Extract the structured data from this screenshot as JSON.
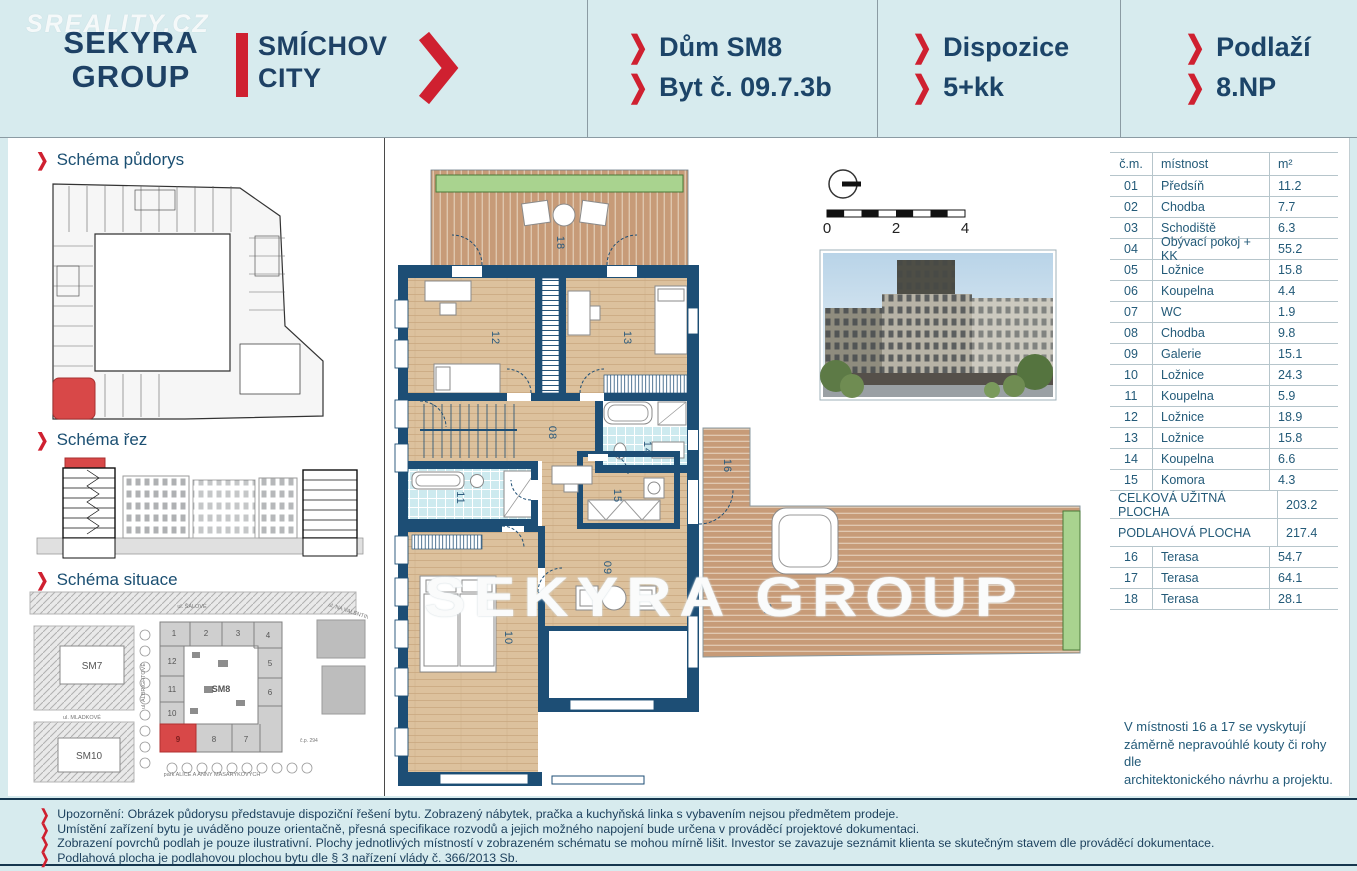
{
  "watermarks": {
    "sreality": "SREALITY.CZ",
    "brand": "SEKYRA GROUP"
  },
  "header": {
    "logo": {
      "line1": "SEKYRA",
      "line2": "GROUP",
      "project1": "SMÍCHOV",
      "project2": "CITY"
    },
    "sections": [
      {
        "line1": "Dům SM8",
        "line2": "Byt č. 09.7.3b"
      },
      {
        "line1": "Dispozice",
        "line2": "5+kk"
      },
      {
        "line1": "Podlaží",
        "line2": "8.NP"
      }
    ]
  },
  "sidebar": {
    "sections": [
      {
        "title": "Schéma půdorys"
      },
      {
        "title": "Schéma řez"
      },
      {
        "title": "Schéma situace"
      }
    ],
    "situace": {
      "blocks": {
        "sm7": "SM7",
        "sm8": "SM8",
        "sm10": "SM10"
      },
      "numbers": [
        "1",
        "2",
        "3",
        "4",
        "5",
        "6",
        "7",
        "8",
        "9",
        "10",
        "11",
        "12"
      ],
      "highlighted_number": "9",
      "streets": {
        "top": "ul. ŠÁLOVÉ",
        "right": "ul. NA VALENTINCE",
        "left_vertical": "ul. ALBRIGHTOVÉ",
        "mid": "ul. MLADKOVÉ",
        "park": "park ALICE A ANNY MASARYKOVÝCH",
        "cp": "č.p. 294"
      }
    }
  },
  "plan": {
    "room_labels": {
      "r08": "08",
      "r09": "09",
      "r10": "10",
      "r11": "11",
      "r12": "12",
      "r13": "13",
      "r14": "14",
      "r15": "15",
      "t16": "16",
      "t17": "17",
      "t18": "18"
    },
    "scale_ticks": {
      "t0": "0",
      "t2": "2",
      "t4": "4"
    }
  },
  "table": {
    "headers": [
      "č.m.",
      "místnost",
      "m²"
    ],
    "rows": [
      [
        "01",
        "Předsíň",
        "11.2"
      ],
      [
        "02",
        "Chodba",
        "7.7"
      ],
      [
        "03",
        "Schodiště",
        "6.3"
      ],
      [
        "04",
        "Obývací pokoj + KK",
        "55.2"
      ],
      [
        "05",
        "Ložnice",
        "15.8"
      ],
      [
        "06",
        "Koupelna",
        "4.4"
      ],
      [
        "07",
        "WC",
        "1.9"
      ],
      [
        "08",
        "Chodba",
        "9.8"
      ],
      [
        "09",
        "Galerie",
        "15.1"
      ],
      [
        "10",
        "Ložnice",
        "24.3"
      ],
      [
        "11",
        "Koupelna",
        "5.9"
      ],
      [
        "12",
        "Ložnice",
        "18.9"
      ],
      [
        "13",
        "Ložnice",
        "15.8"
      ],
      [
        "14",
        "Koupelna",
        "6.6"
      ],
      [
        "15",
        "Komora",
        "4.3"
      ]
    ],
    "summary": [
      [
        "CELKOVÁ UŽITNÁ PLOCHA",
        "203.2"
      ],
      [
        "PODLAHOVÁ PLOCHA",
        "217.4"
      ]
    ],
    "terrace_rows": [
      [
        "16",
        "Terasa",
        "54.7"
      ],
      [
        "17",
        "Terasa",
        "64.1"
      ],
      [
        "18",
        "Terasa",
        "28.1"
      ]
    ],
    "note_lines": [
      "V místnosti 16 a 17 se vyskytují",
      "záměrně nepravoúhlé kouty či rohy dle",
      "architektonického návrhu a projektu."
    ]
  },
  "disclaimer": {
    "lines": [
      "Upozornění: Obrázek půdorysu představuje dispoziční řešení bytu. Zobrazený nábytek, pračka a kuchyňská linka s vybavením nejsou předmětem prodeje.",
      "Umístění zařízení bytu je uváděno pouze orientačně, přesná specifikace rozvodů a jejich možného napojení bude určena v prováděcí projektové dokumentaci.",
      "Zobrazení povrchů podlah je pouze ilustrativní. Plochy jednotlivých místností v zobrazeném schématu se mohou mírně lišit. Investor se zavazuje seznámit klienta se skutečným stavem dle prováděcí dokumentace.",
      "Podlahová plocha je podlahovou plochou bytu dle § 3 nařízení vlády č. 366/2013 Sb."
    ]
  },
  "colors": {
    "page_bg": "#d7ebee",
    "navy_text": "#1c4468",
    "accent_red": "#cf2030",
    "wall": "#1d4e75",
    "wood_floor": "#dcc19d",
    "deck": "#c79b78",
    "tile": "#cdeaef",
    "planter_green": "#a9d38f",
    "highlight_red": "#d84848"
  }
}
